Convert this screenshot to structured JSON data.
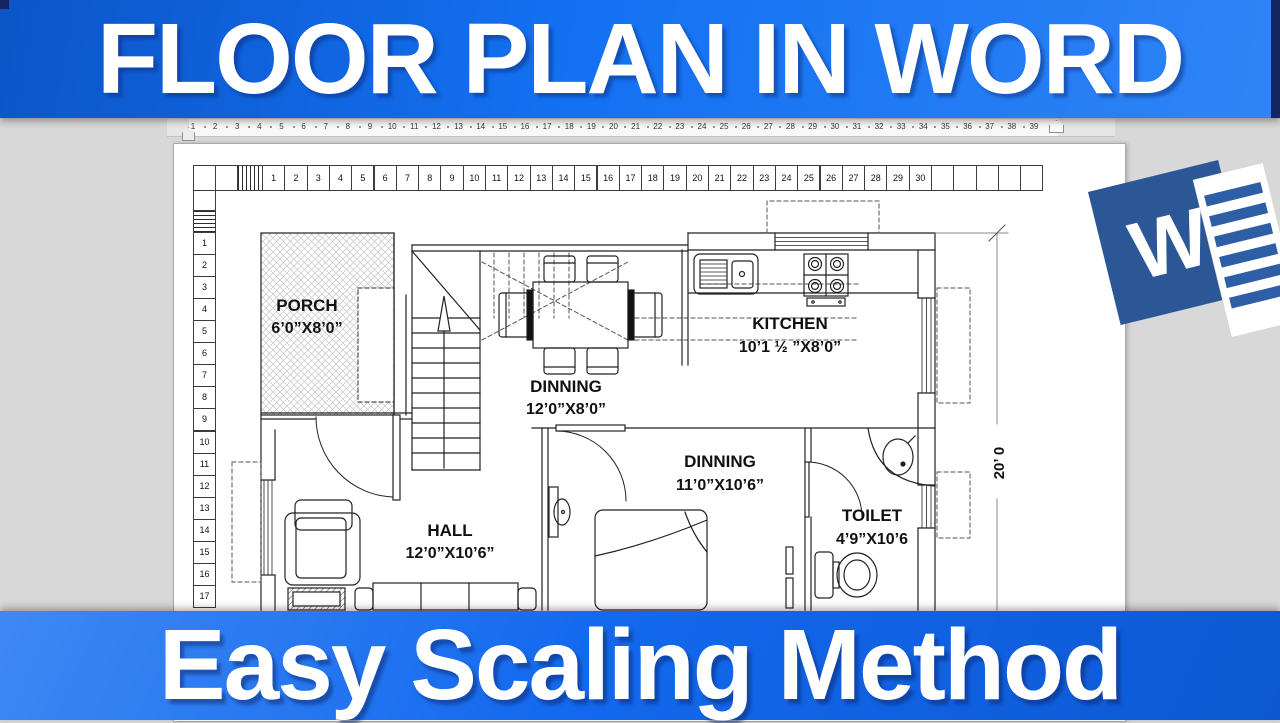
{
  "top_banner": {
    "text": "FLOOR PLAN IN WORD"
  },
  "bottom_banner": {
    "text": "Easy Scaling Method"
  },
  "word_app": {
    "ruler_numbers": [
      "1",
      "2",
      "3",
      "4",
      "5",
      "6",
      "7",
      "8",
      "9",
      "10",
      "11",
      "12",
      "13",
      "14",
      "15",
      "16",
      "17",
      "18",
      "19",
      "20",
      "21",
      "22",
      "23",
      "24",
      "25",
      "26",
      "27",
      "28",
      "29",
      "30",
      "31",
      "32",
      "33",
      "34",
      "35",
      "36",
      "37",
      "38",
      "39"
    ]
  },
  "document_grid": {
    "h_numbers": [
      "1",
      "2",
      "3",
      "4",
      "5",
      "6",
      "7",
      "8",
      "9",
      "10",
      "11",
      "12",
      "13",
      "14",
      "15",
      "16",
      "17",
      "18",
      "19",
      "20",
      "21",
      "22",
      "23",
      "24",
      "25",
      "26",
      "27",
      "28",
      "29",
      "30"
    ],
    "v_numbers": [
      "1",
      "2",
      "3",
      "4",
      "5",
      "6",
      "7",
      "8",
      "9",
      "10",
      "11",
      "12",
      "13",
      "14",
      "15",
      "16",
      "17"
    ]
  },
  "floor_plan": {
    "rooms": [
      {
        "id": "porch",
        "name": "PORCH",
        "dims": "6’0”X8’0”"
      },
      {
        "id": "dinning1",
        "name": "DINNING",
        "dims": "12’0”X8’0”"
      },
      {
        "id": "kitchen",
        "name": "KITCHEN",
        "dims": "10’1 ½ ”X8’0”"
      },
      {
        "id": "hall",
        "name": "HALL",
        "dims": "12’0”X10’6”"
      },
      {
        "id": "dinning2",
        "name": "DINNING",
        "dims": "11’0”X10’6”"
      },
      {
        "id": "toilet",
        "name": "TOILET",
        "dims": "4’9”X10’6"
      }
    ],
    "right_dimension_label": "20’ 0"
  },
  "word_logo": {
    "letter": "W"
  },
  "colors": {
    "banner_blue": "#1371f2",
    "banner_dark_edge": "#13265f",
    "word_logo_blue": "#2b5797",
    "workspace_gray": "#d8d8d8",
    "page_white": "#ffffff"
  }
}
